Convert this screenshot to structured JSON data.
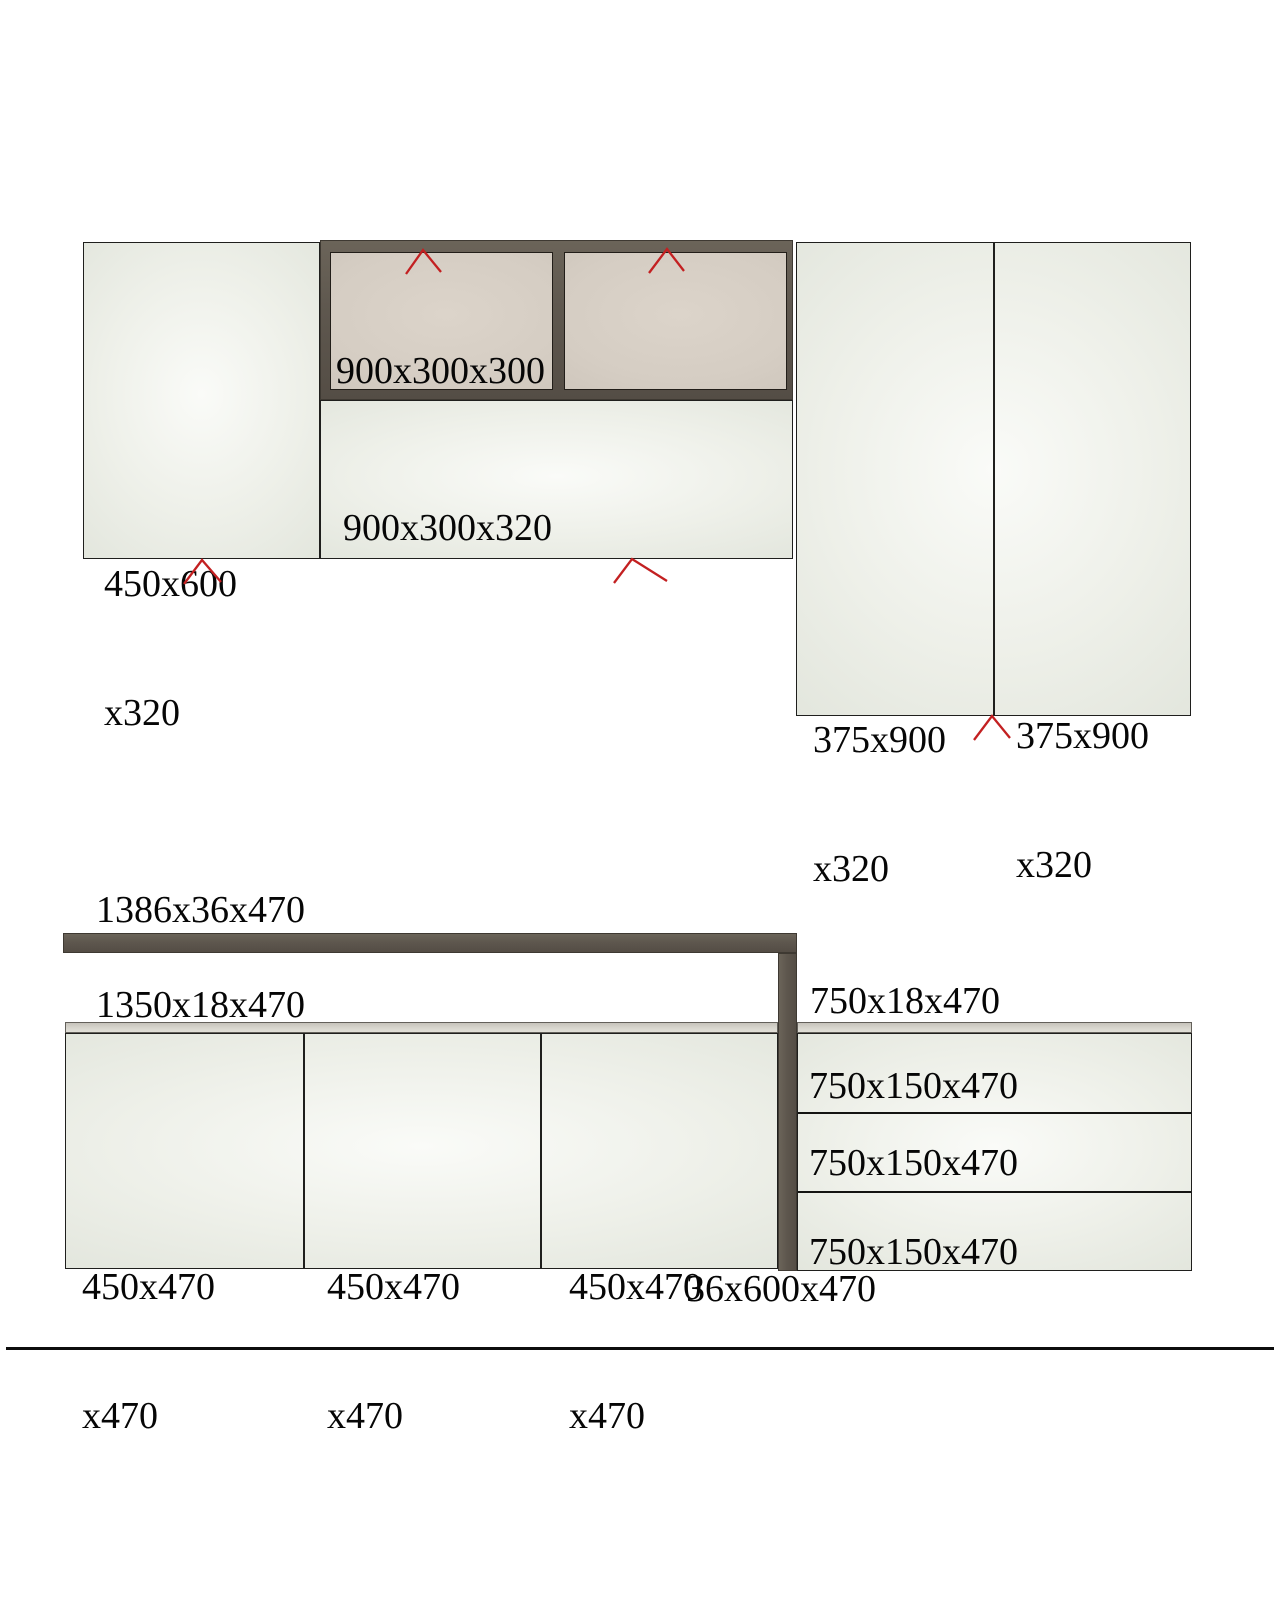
{
  "colors": {
    "background": "#ffffff",
    "frame_dark": "#5e574e",
    "door_tan": "#d5cdc3",
    "panel_light": "#eef0e9",
    "shelf_strip": "#d8d6ce",
    "marker_red": "#c32021",
    "rule_black": "#0d0d0d"
  },
  "upper_assembly": {
    "side_panel": {
      "line1": "450x600",
      "line2": "x320"
    },
    "wall_box_door_label": "900x300x300",
    "base_front_label": "900x300x320",
    "tall_door_left": {
      "line1": "375x900",
      "line2": "x320"
    },
    "tall_door_right": {
      "line1": "375x900",
      "line2": "x320"
    }
  },
  "lower_assembly": {
    "top_rail_label": "1386x36x470",
    "left_shelf_label": "1350x18x470",
    "right_shelf_label": "750x18x470",
    "side_divider_label": "36x600x470",
    "doors": [
      {
        "line1": "450x470",
        "line2": "x470"
      },
      {
        "line1": "450x470",
        "line2": "x470"
      },
      {
        "line1": "450x470",
        "line2": "x470"
      }
    ],
    "drawers": [
      {
        "label": "750x150x470"
      },
      {
        "label": "750x150x470"
      },
      {
        "label": "750x150x470"
      }
    ]
  }
}
